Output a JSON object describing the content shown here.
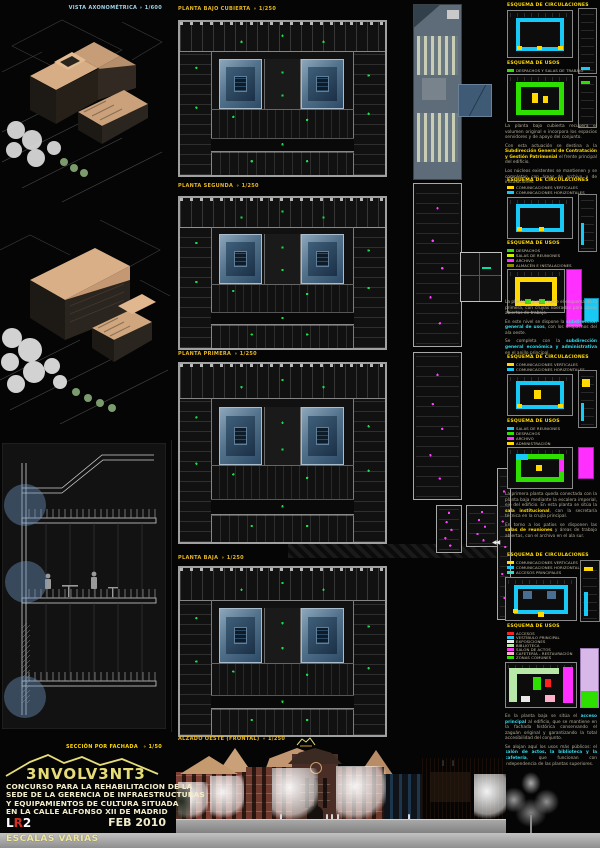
{
  "palette": {
    "background": "#050505",
    "title_yellow": "#e8b820",
    "accent_yellow": "#ffd900",
    "accent_cyan": "#18c8f5",
    "accent_green": "#2ee000",
    "accent_magenta": "#ff30ff",
    "accent_red": "#ff2020",
    "courtyard_blue": "#53728c",
    "logo_yellow": "#e6dd78",
    "cream_text": "#f2ecca",
    "axon_title_blue": "#9fd4e8"
  },
  "left": {
    "axon_title": "VISTA AXONOMÉTRICA",
    "axon_scale": "∘ 1/600",
    "section_title": "SECCIÓN POR FACHADA",
    "section_scale": "∘ 1/50"
  },
  "plans": [
    {
      "title": "PLANTA BAJO CUBIERTA",
      "scale": "∘ 1/250"
    },
    {
      "title": "PLANTA SEGUNDA",
      "scale": "∘ 1/250"
    },
    {
      "title": "PLANTA PRIMERA",
      "scale": "∘ 1/250"
    },
    {
      "title": "PLANTA BAJA",
      "scale": "∘ 1/250"
    }
  ],
  "elevation": {
    "title": "ALZADO OESTE (FRONTAL)",
    "scale": "∘ 1/250"
  },
  "titleblock": {
    "logo": "3NVOLV3NT3",
    "lines": [
      "CONCURSO PARA LA REHABILITACION DE LA",
      "SEDE DE LA GERENCIA DE INFRAESTRUCTURAS",
      "Y EQUIPAMIENTOS DE CULTURA SITUADA",
      "EN LA CALLE ALFONSO XII DE MADRID"
    ],
    "sheet_l": "L",
    "sheet_r": "R",
    "sheet_n": "2",
    "date": "FEB 2010",
    "scales": "ESCALAS VARIAS"
  },
  "shared": {
    "circ_title": "ESQUEMA DE CIRCULACIONES",
    "usos_title": "ESQUEMA DE USOS"
  },
  "groups": [
    {
      "usos_legend": [
        {
          "label": "Despachos y salas de trabajo",
          "color": "#2ee000",
          "sw": "background:#2ee000"
        }
      ],
      "paras": [
        {
          "pre": "La planta bajo cubierta recupera el volumen original e incorpora los espacios servidores y de apoyo del conjunto.",
          "hl": "",
          "post": ""
        },
        {
          "pre": "Con esta actuación se destina a la ",
          "hl": "Subdirección General de Contratación y Gestión Patrimonial",
          "post": " el frente principal del edificio."
        },
        {
          "pre": "Los núcleos existentes se mantienen y se completan con áreas de archivo y de instalaciones.",
          "hl": "",
          "post": ""
        }
      ]
    },
    {
      "circ_legend": [
        {
          "label": "Comunicaciones verticales",
          "color": "#ffd900",
          "sw": "background:#ffd900"
        },
        {
          "label": "Comunicaciones horizontales",
          "color": "#18c8f5",
          "sw": "background:#18c8f5"
        }
      ],
      "usos_legend": [
        {
          "label": "Despachos",
          "color": "#2ee000",
          "sw": "background:#2ee000"
        },
        {
          "label": "Salas de reuniones",
          "color": "#ccf000",
          "sw": "background:#ccf000"
        },
        {
          "label": "Archivo",
          "color": "#ff30ff",
          "sw": "background:#ff30ff"
        },
        {
          "label": "Almacén e instalaciones",
          "color": "#8a8a00",
          "sw": "background:#8a8a00"
        }
      ],
      "paras": [
        {
          "pre": "La planta segunda repite el esquema de la primera, con crujías liberadas para zonas abiertas de trabajo.",
          "hl": "",
          "post": ""
        },
        {
          "pre": "En este nivel se dispone la ",
          "hl": "subdirección general de usos",
          "post": ", con los despachos del ala oeste."
        },
        {
          "pre": "Se completa con la ",
          "hl": "subdirección general económica y administrativa",
          "post": " en el anillo principal."
        }
      ]
    },
    {
      "circ_legend": [
        {
          "label": "Comunicaciones verticales",
          "color": "#ffd900",
          "sw": "background:#ffd900"
        },
        {
          "label": "Comunicaciones horizontales",
          "color": "#18c8f5",
          "sw": "background:#18c8f5"
        }
      ],
      "usos_legend": [
        {
          "label": "Salas de reuniones",
          "color": "#18c8f5",
          "sw": "background:#18c8f5"
        },
        {
          "label": "Despachos",
          "color": "#2ee000",
          "sw": "background:#2ee000"
        },
        {
          "label": "Archivo",
          "color": "#ff30ff",
          "sw": "background:#ff30ff"
        },
        {
          "label": "Administración",
          "color": "#ffd900",
          "sw": "background:#ffd900"
        }
      ],
      "paras": [
        {
          "pre": "La primera planta queda conectada con la planta baja mediante la escalera imperial, eje del edificio. En esta planta se sitúa la ",
          "hl": "sala institucional",
          "post": ", con la secretaría técnica en la crujía principal."
        },
        {
          "pre": "En torno a los patios se disponen las ",
          "hl": "salas de reuniones",
          "post": " y áreas de trabajo abiertas, con el archivo en el ala sur."
        }
      ]
    },
    {
      "circ_legend": [
        {
          "label": "Comunicaciones verticales",
          "color": "#ffd900",
          "sw": "background:#ffd900"
        },
        {
          "label": "Comunicaciones horizontales",
          "color": "#18c8f5",
          "sw": "background:#18c8f5"
        },
        {
          "label": "Accesos principales",
          "color": "#2ee0c0",
          "sw": "background:#2ee0c0"
        }
      ],
      "usos_legend": [
        {
          "label": "Accesos",
          "color": "#ff2020",
          "sw": "background:#ff2020"
        },
        {
          "label": "Vestíbulo principal",
          "color": "#18c8f5",
          "sw": "background:#18c8f5"
        },
        {
          "label": "Exposiciones",
          "color": "#e8e8e8",
          "sw": "background:#e8e8e8"
        },
        {
          "label": "Biblioteca",
          "color": "#b8e8a8",
          "sw": "background:#b8e8a8"
        },
        {
          "label": "Salón de actos",
          "color": "#ff30ff",
          "sw": "background:#ff30ff"
        },
        {
          "label": "Cafetería - restauración",
          "color": "#ffb0c8",
          "sw": "background:#ffb0c8"
        },
        {
          "label": "Zonas comunes",
          "color": "#2ee000",
          "sw": "background:#2ee000"
        }
      ],
      "paras": [
        {
          "pre": "En la planta baja se sitúa el ",
          "hl": "acceso principal",
          "post": " al edificio, que se mantiene en la fachada histórica conservando el zaguán original y garantizando la total accesibilidad del conjunto."
        },
        {
          "pre": "Se alojan aquí los usos más públicos: el ",
          "hl": "salón de actos, la biblioteca y la cafetería",
          "post": ", que funcionan con independencia de las plantas superiores."
        }
      ]
    }
  ]
}
